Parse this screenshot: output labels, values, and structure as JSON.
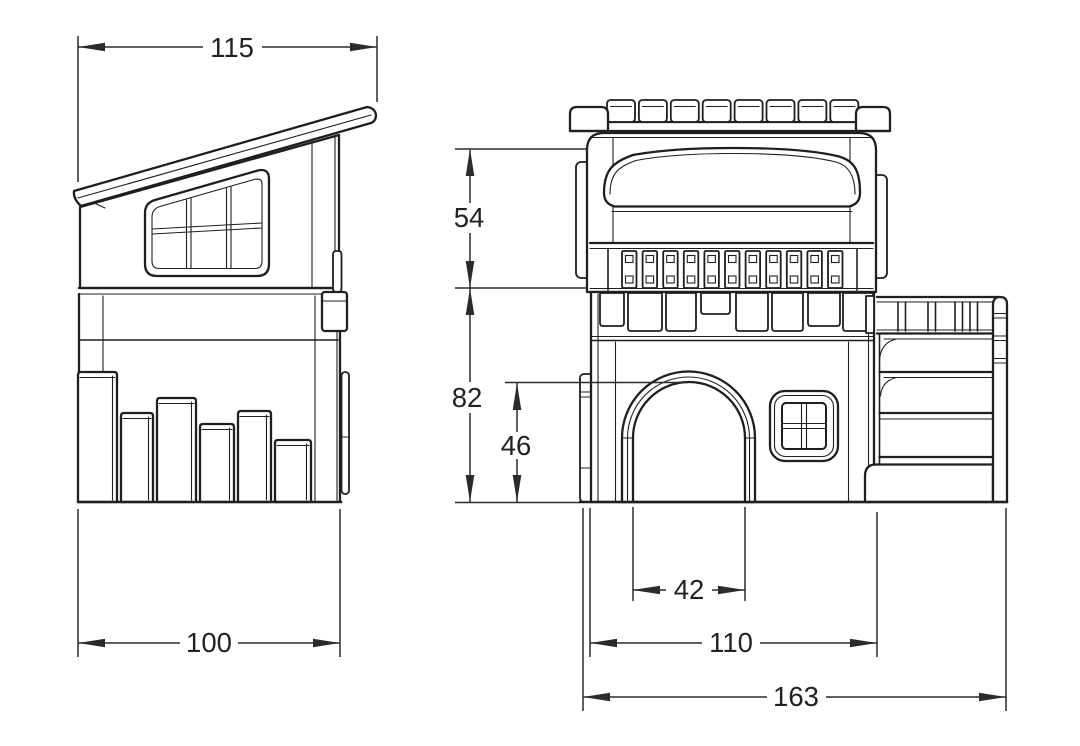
{
  "page": {
    "background": "#ffffff",
    "line_color": "#1f1f1f"
  },
  "side_view": {
    "dim_roof_width": "115",
    "dim_base_width": "100"
  },
  "front_view": {
    "dim_upper_height": "54",
    "dim_lower_height": "82",
    "dim_door_height": "46",
    "dim_door_width": "42",
    "dim_body_width": "110",
    "dim_overall_width": "163"
  }
}
